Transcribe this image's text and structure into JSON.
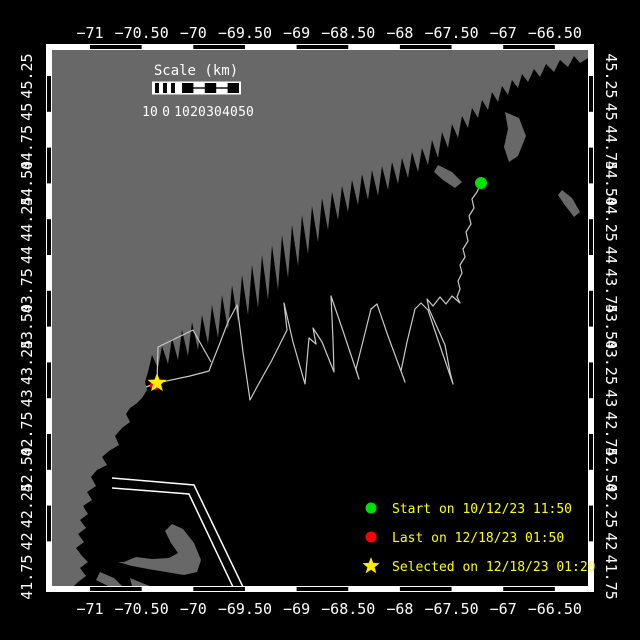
{
  "title": "Vessel track map",
  "colors": {
    "background": "#000000",
    "land": "#686868",
    "ocean": "#000000",
    "frame": "#ffffff",
    "track": "#c8c8c8",
    "lane": "#ffffff",
    "start_marker": "#00e000",
    "last_marker": "#ff0000",
    "selected_marker": "#ffee00",
    "legend_text": "#ffff00",
    "axis_text": "#ffffff"
  },
  "axes": {
    "lon_labels": [
      "−71",
      "−70.50",
      "−70",
      "−69.50",
      "−69",
      "−68.50",
      "−68",
      "−67.50",
      "−67",
      "−66.50"
    ],
    "lat_labels": [
      "45.25",
      "45",
      "44.75",
      "44.50",
      "44.25",
      "44",
      "43.75",
      "43.50",
      "43.25",
      "43",
      "42.75",
      "42.50",
      "42.25",
      "42",
      "41.75"
    ]
  },
  "scale_bar": {
    "title": "Scale (km)",
    "labels": [
      "10",
      "0",
      "10",
      "20",
      "30",
      "40",
      "50"
    ]
  },
  "legend": [
    {
      "marker": "green-dot",
      "label": "Start on 10/12/23 11:50"
    },
    {
      "marker": "red-dot",
      "label": "Last on 12/18/23 01:50"
    },
    {
      "marker": "yellow-star",
      "label": "Selected on 12/18/23 01:20"
    }
  ],
  "map_data": {
    "markers": {
      "start": {
        "x": 481,
        "y": 183
      },
      "last": {
        "x": 155,
        "y": 385
      },
      "selected": {
        "x": 157,
        "y": 383
      }
    },
    "track_points": [
      [
        481,
        183
      ],
      [
        477,
        192
      ],
      [
        472,
        199
      ],
      [
        474,
        208
      ],
      [
        469,
        216
      ],
      [
        471,
        224
      ],
      [
        466,
        232
      ],
      [
        468,
        241
      ],
      [
        463,
        249
      ],
      [
        465,
        257
      ],
      [
        460,
        265
      ],
      [
        462,
        273
      ],
      [
        458,
        281
      ],
      [
        460,
        289
      ],
      [
        457,
        297
      ],
      [
        460,
        303
      ],
      [
        452,
        296
      ],
      [
        446,
        304
      ],
      [
        440,
        297
      ],
      [
        433,
        306
      ],
      [
        427,
        299
      ],
      [
        429,
        309
      ],
      [
        445,
        345
      ],
      [
        450,
        372
      ],
      [
        453,
        384
      ],
      [
        438,
        340
      ],
      [
        428,
        310
      ],
      [
        421,
        303
      ],
      [
        415,
        309
      ],
      [
        407,
        342
      ],
      [
        401,
        371
      ],
      [
        405,
        382
      ],
      [
        388,
        336
      ],
      [
        377,
        304
      ],
      [
        371,
        309
      ],
      [
        363,
        341
      ],
      [
        356,
        369
      ],
      [
        359,
        379
      ],
      [
        342,
        328
      ],
      [
        331,
        296
      ],
      [
        333,
        340
      ],
      [
        334,
        372
      ],
      [
        322,
        342
      ],
      [
        313,
        328
      ],
      [
        316,
        344
      ],
      [
        309,
        338
      ],
      [
        305,
        384
      ],
      [
        293,
        342
      ],
      [
        284,
        303
      ],
      [
        287,
        330
      ],
      [
        272,
        360
      ],
      [
        258,
        385
      ],
      [
        250,
        400
      ],
      [
        243,
        352
      ],
      [
        237,
        305
      ],
      [
        228,
        322
      ],
      [
        218,
        348
      ],
      [
        212,
        363
      ],
      [
        209,
        371
      ],
      [
        190,
        376
      ],
      [
        157,
        383
      ],
      [
        158,
        347
      ],
      [
        193,
        330
      ],
      [
        211,
        362
      ]
    ],
    "track_stub": [
      [
        146,
        387
      ],
      [
        157,
        383
      ]
    ],
    "lane_lines": [
      [
        [
          112,
          478
        ],
        [
          194,
          485
        ],
        [
          243,
          587
        ]
      ],
      [
        [
          112,
          488
        ],
        [
          189,
          494
        ],
        [
          233,
          587
        ]
      ]
    ],
    "land_polygons": [
      [
        [
          52,
          50
        ],
        [
          588,
          50
        ],
        [
          588,
          58
        ],
        [
          580,
          63
        ],
        [
          574,
          56
        ],
        [
          568,
          67
        ],
        [
          560,
          60
        ],
        [
          554,
          72
        ],
        [
          546,
          64
        ],
        [
          540,
          77
        ],
        [
          534,
          69
        ],
        [
          528,
          82
        ],
        [
          522,
          74
        ],
        [
          518,
          88
        ],
        [
          512,
          80
        ],
        [
          508,
          95
        ],
        [
          502,
          86
        ],
        [
          498,
          102
        ],
        [
          492,
          92
        ],
        [
          488,
          110
        ],
        [
          482,
          100
        ],
        [
          478,
          118
        ],
        [
          472,
          108
        ],
        [
          468,
          128
        ],
        [
          462,
          116
        ],
        [
          458,
          138
        ],
        [
          452,
          124
        ],
        [
          448,
          148
        ],
        [
          442,
          132
        ],
        [
          438,
          158
        ],
        [
          432,
          140
        ],
        [
          428,
          165
        ],
        [
          422,
          148
        ],
        [
          418,
          172
        ],
        [
          412,
          152
        ],
        [
          408,
          178
        ],
        [
          402,
          158
        ],
        [
          398,
          184
        ],
        [
          392,
          162
        ],
        [
          388,
          190
        ],
        [
          382,
          166
        ],
        [
          378,
          196
        ],
        [
          372,
          170
        ],
        [
          368,
          200
        ],
        [
          362,
          174
        ],
        [
          358,
          205
        ],
        [
          352,
          180
        ],
        [
          348,
          212
        ],
        [
          342,
          186
        ],
        [
          338,
          220
        ],
        [
          332,
          192
        ],
        [
          328,
          230
        ],
        [
          322,
          198
        ],
        [
          318,
          242
        ],
        [
          312,
          206
        ],
        [
          308,
          254
        ],
        [
          302,
          215
        ],
        [
          298,
          266
        ],
        [
          292,
          225
        ],
        [
          288,
          278
        ],
        [
          282,
          235
        ],
        [
          278,
          290
        ],
        [
          272,
          245
        ],
        [
          268,
          300
        ],
        [
          262,
          255
        ],
        [
          258,
          308
        ],
        [
          252,
          265
        ],
        [
          248,
          315
        ],
        [
          242,
          275
        ],
        [
          238,
          322
        ],
        [
          232,
          285
        ],
        [
          228,
          330
        ],
        [
          222,
          295
        ],
        [
          218,
          338
        ],
        [
          212,
          305
        ],
        [
          208,
          344
        ],
        [
          202,
          315
        ],
        [
          198,
          350
        ],
        [
          192,
          322
        ],
        [
          188,
          356
        ],
        [
          182,
          330
        ],
        [
          178,
          360
        ],
        [
          172,
          338
        ],
        [
          168,
          364
        ],
        [
          162,
          346
        ],
        [
          158,
          368
        ],
        [
          152,
          355
        ],
        [
          148,
          372
        ],
        [
          145,
          382
        ],
        [
          147,
          390
        ],
        [
          142,
          398
        ],
        [
          136,
          404
        ],
        [
          130,
          408
        ],
        [
          126,
          414
        ],
        [
          130,
          422
        ],
        [
          122,
          428
        ],
        [
          115,
          436
        ],
        [
          119,
          445
        ],
        [
          109,
          451
        ],
        [
          102,
          457
        ],
        [
          107,
          465
        ],
        [
          97,
          470
        ],
        [
          91,
          477
        ],
        [
          96,
          486
        ],
        [
          87,
          492
        ],
        [
          92,
          500
        ],
        [
          83,
          506
        ],
        [
          88,
          514
        ],
        [
          80,
          520
        ],
        [
          86,
          528
        ],
        [
          78,
          534
        ],
        [
          84,
          542
        ],
        [
          76,
          548
        ],
        [
          82,
          556
        ],
        [
          88,
          562
        ],
        [
          80,
          568
        ],
        [
          86,
          576
        ],
        [
          78,
          582
        ],
        [
          74,
          586
        ],
        [
          52,
          586
        ]
      ],
      [
        [
          118,
          562
        ],
        [
          132,
          566
        ],
        [
          148,
          569
        ],
        [
          166,
          572
        ],
        [
          184,
          575
        ],
        [
          197,
          572
        ],
        [
          201,
          560
        ],
        [
          194,
          543
        ],
        [
          183,
          529
        ],
        [
          172,
          524
        ],
        [
          165,
          531
        ],
        [
          171,
          543
        ],
        [
          178,
          553
        ],
        [
          169,
          558
        ],
        [
          152,
          559
        ],
        [
          136,
          557
        ],
        [
          124,
          562
        ]
      ],
      [
        [
          505,
          112
        ],
        [
          519,
          118
        ],
        [
          526,
          136
        ],
        [
          518,
          156
        ],
        [
          509,
          162
        ],
        [
          504,
          147
        ],
        [
          508,
          129
        ]
      ],
      [
        [
          562,
          190
        ],
        [
          572,
          198
        ],
        [
          580,
          212
        ],
        [
          574,
          217
        ],
        [
          564,
          204
        ],
        [
          558,
          195
        ]
      ],
      [
        [
          438,
          165
        ],
        [
          452,
          172
        ],
        [
          462,
          182
        ],
        [
          455,
          188
        ],
        [
          443,
          180
        ],
        [
          434,
          172
        ]
      ],
      [
        [
          100,
          572
        ],
        [
          114,
          578
        ],
        [
          122,
          586
        ],
        [
          108,
          586
        ],
        [
          96,
          580
        ]
      ],
      [
        [
          130,
          578
        ],
        [
          142,
          583
        ],
        [
          150,
          586
        ],
        [
          132,
          586
        ]
      ]
    ]
  }
}
